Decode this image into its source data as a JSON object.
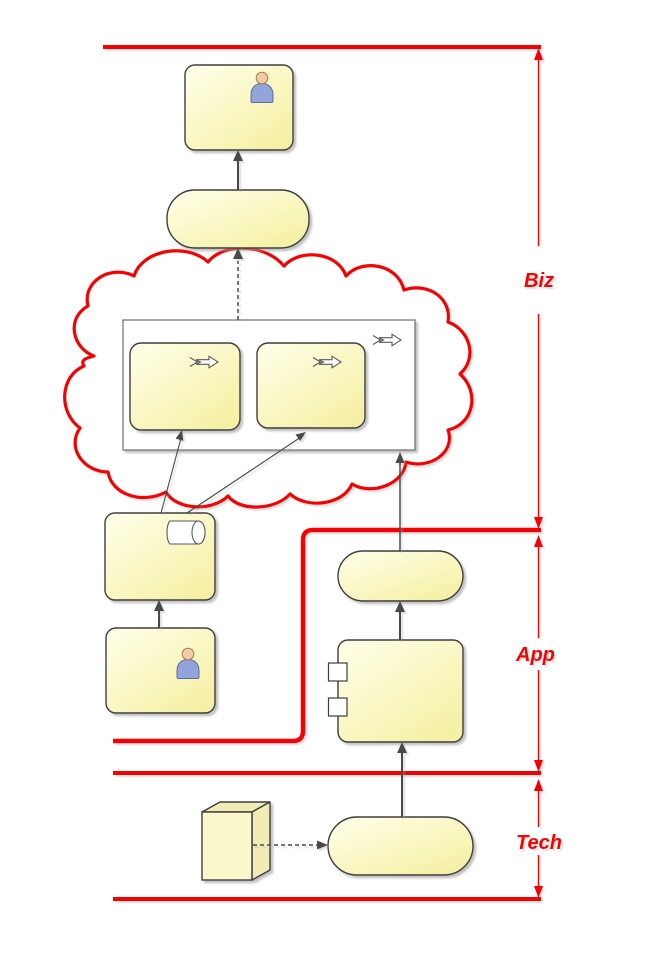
{
  "layers": [
    {
      "id": "biz",
      "label": "Biz"
    },
    {
      "id": "app",
      "label": "App"
    },
    {
      "id": "tech",
      "label": "Tech"
    }
  ],
  "colors": {
    "background": "#ffffff",
    "annotation_red": "#f40000",
    "shape_fill_light": "#ffffea",
    "shape_fill_dark": "#f5f0a3",
    "shape_border": "#3d3d3d",
    "container_border": "#6e6e6e",
    "connector_dark": "#4a4a4a",
    "icon_stroke": "#5a5a5a",
    "actor_head_fill": "#f2cba6",
    "actor_head_border": "#a57b4f",
    "actor_body_fill": "#93a4db",
    "actor_body_border": "#5d6c9f",
    "cube_front_fill": "#faf7cd",
    "cube_side_fill": "#f1ecb6"
  },
  "icons": {
    "actor": "person figure (head + shoulders)",
    "process_arrow": "outlined right arrow with chevron tail",
    "cylinder": "horizontal white cylinder",
    "component_ports": "two protruding white squares",
    "cube": "3d rectangular node"
  },
  "nodes": [
    {
      "id": "biz-actor-box",
      "icon": "actor"
    },
    {
      "id": "biz-service-pill",
      "icon": ""
    },
    {
      "id": "process-cloud",
      "icon": ""
    },
    {
      "id": "process-container",
      "icon": "process_arrow"
    },
    {
      "id": "process-box-1",
      "icon": "process_arrow"
    },
    {
      "id": "process-box-2",
      "icon": "process_arrow"
    },
    {
      "id": "cylinder-box",
      "icon": "cylinder"
    },
    {
      "id": "app-actor-box",
      "icon": "actor"
    },
    {
      "id": "app-service-pill",
      "icon": ""
    },
    {
      "id": "app-component-box",
      "icon": "component_ports"
    },
    {
      "id": "tech-node-cube",
      "icon": "cube"
    },
    {
      "id": "tech-service-pill",
      "icon": ""
    }
  ]
}
